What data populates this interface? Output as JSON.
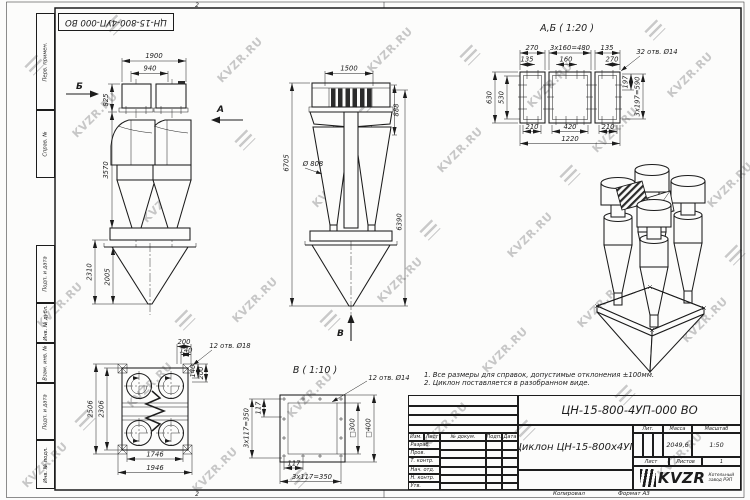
{
  "meta": {
    "zone_top": "2",
    "zone_bottom": "2"
  },
  "top_stamp": "ЦН-15-800-4УП-000 ВО",
  "margin_labels": {
    "perv_primen": "Перв. примен.",
    "sprav_no": "Справ. №",
    "podp_data_1": "Подп. и дата",
    "inv_dubl": "Инв. № дубл.",
    "vzam_inv": "Взам. инв. №",
    "podp_data_2": "Подп. и дата",
    "inv_podl": "Инв. № подл."
  },
  "views": {
    "side": {
      "arrow_b": "Б",
      "arrow_a": "А",
      "dim_1900": "1900",
      "dim_940": "940",
      "dim_825": "825",
      "dim_3570": "3570",
      "dim_2310": "2310",
      "dim_2005": "2005"
    },
    "front": {
      "arrow_v": "В",
      "dim_1500": "1500",
      "dim_888": "888",
      "dim_d808": "Ø 808",
      "dim_6705": "6705",
      "dim_6390": "6390"
    },
    "detail_ab": {
      "title": "А,Б ( 1:20 )",
      "dim_270l": "270",
      "dim_480": "3х160=480",
      "dim_270r": "270",
      "dim_135l": "135",
      "dim_160": "160",
      "dim_135r": "135",
      "holes": "32 отв. Ø14",
      "dim_630": "630",
      "dim_530": "530",
      "dim_197": "197",
      "dim_590": "3х197=590",
      "dim_210l": "210",
      "dim_420": "420",
      "dim_210r": "210",
      "dim_1220": "1220"
    },
    "plan": {
      "dim_200t": "200",
      "dim_140t": "140",
      "holes": "12 отв. Ø18",
      "dim_140r": "140",
      "dim_200r": "200",
      "dim_2506": "2506",
      "dim_2306": "2306",
      "dim_1746": "1746",
      "dim_1946": "1946"
    },
    "detail_v": {
      "title": "В ( 1:10 )",
      "holes": "12 отв. Ø14",
      "dim_117l": "117",
      "dim_350l": "3х117=350",
      "dim_sq300": "□300",
      "dim_sq400": "□400",
      "dim_117b": "117",
      "dim_350b": "3х117=350"
    }
  },
  "notes": {
    "line1": "1. Все размеры для справок, допустимые отклонения ±100мм.",
    "line2": "2. Циклон поставляется в разобранном виде."
  },
  "title_block": {
    "doc_number": "ЦН-15-800-4УП-000 ВО",
    "product_name": "Циклон ЦН-15-800х4УП",
    "h_izm": "Изм.",
    "h_list": "Лист",
    "h_doc": "№ докум.",
    "h_podp": "Подп.",
    "h_data": "Дата",
    "r1": "Разраб.",
    "r2": "Пров.",
    "r3": "Т. контр.",
    "r4": "Нач. отд.",
    "r5": "Н. контр.",
    "r6": "Утв.",
    "h_lit": "Лит.",
    "h_mass": "Масса",
    "h_scale": "Масштаб",
    "mass": "2049,6",
    "scale": "1:50",
    "h_sheet": "Лист",
    "h_sheets": "Листов",
    "sheets_value": "1",
    "logo_text": "KVZR",
    "logo_caption_1": "Котельный",
    "logo_caption_2": "завод РЭП",
    "copied": "Копировал",
    "format": "Формат А3"
  },
  "watermark": {
    "text": "KVZR.RU"
  }
}
